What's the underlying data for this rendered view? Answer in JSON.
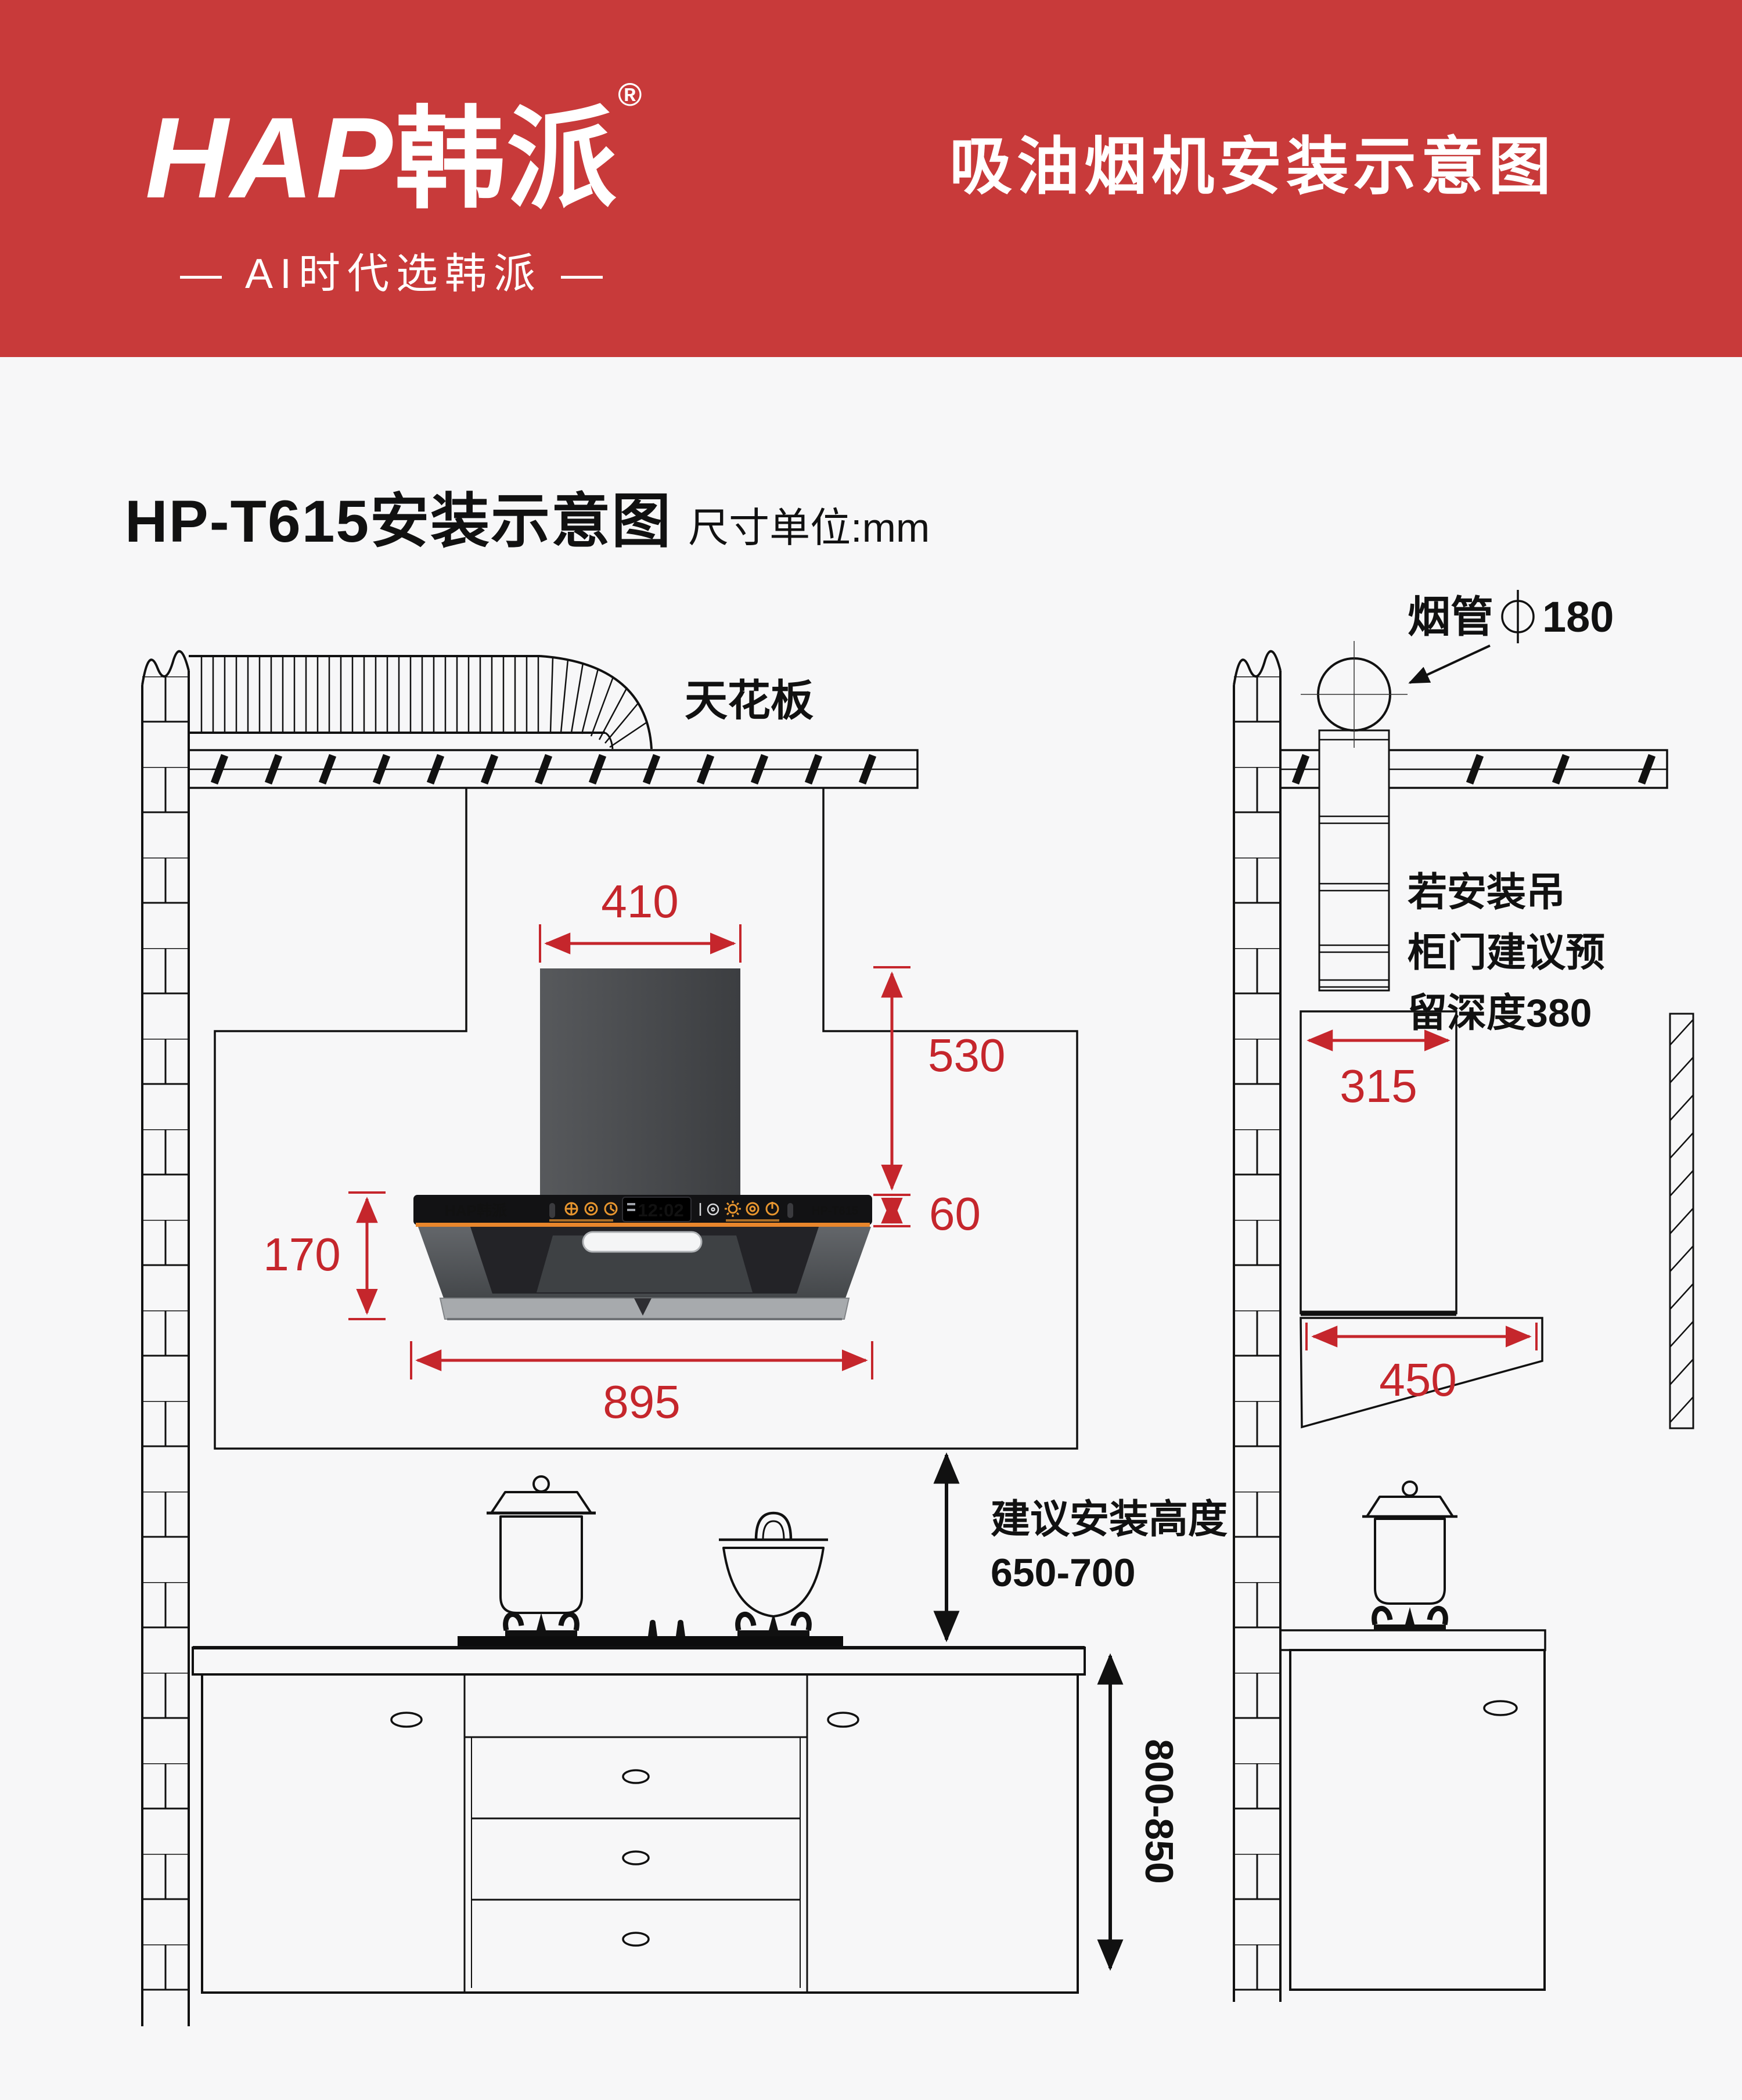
{
  "banner": {
    "logo_en": "HAP",
    "logo_cn": "韩派",
    "reg": "®",
    "slogan": "— AI时代选韩派 —",
    "title": "吸油烟机安装示意图",
    "bg_color": "#C83A3A"
  },
  "heading": {
    "model_title": "HP-T615安装示意图",
    "unit_note": "尺寸单位:mm"
  },
  "colors": {
    "dimension_red": "#C5262C",
    "accent_orange": "#E8962F"
  },
  "front_view": {
    "ceiling_label": "天花板",
    "dims": {
      "chimney_width": "410",
      "chimney_height": "530",
      "panel_height": "60",
      "hood_body_height": "170",
      "hood_total_width": "895"
    },
    "install_height_label": "建议安装高度",
    "install_height_range": "650-700",
    "counter_height_range": "800-850",
    "hood": {
      "brand": "HAP韩派",
      "clock": "12:02",
      "model": "HP-T615"
    }
  },
  "side_view": {
    "pipe_label": "烟管",
    "pipe_diameter": "180",
    "cabinet_note_line1": "若安装吊",
    "cabinet_note_line2": "柜门建议预",
    "cabinet_note_line3": "留深度380",
    "cabinet_depth": "315",
    "hood_depth": "450"
  }
}
